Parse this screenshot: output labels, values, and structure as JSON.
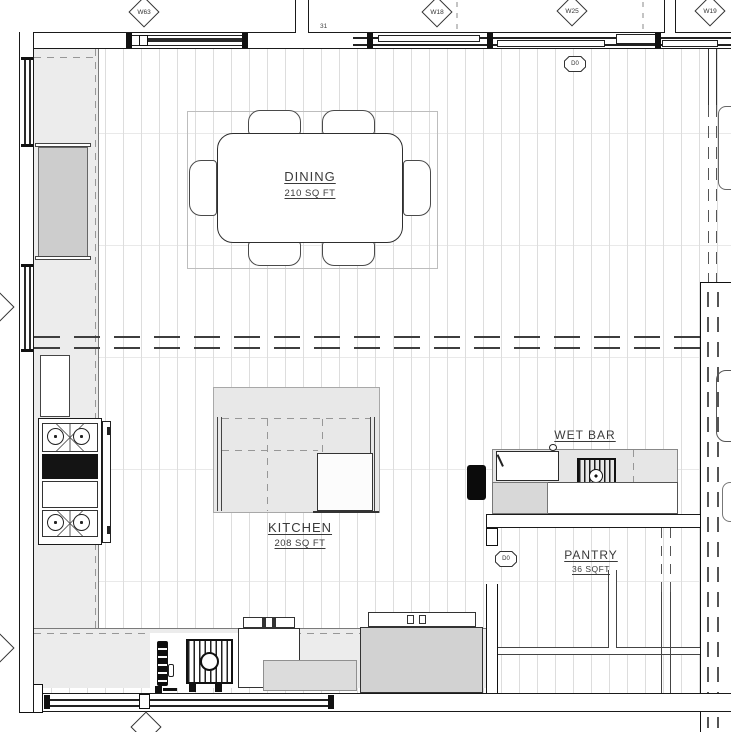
{
  "rooms": {
    "dining": {
      "name": "DINING",
      "area": "210 SQ FT"
    },
    "kitchen": {
      "name": "KITCHEN",
      "area": "208 SQ FT"
    },
    "wet_bar": {
      "name": "WET BAR"
    },
    "pantry": {
      "name": "PANTRY",
      "area": "36 SQFT"
    }
  },
  "tags": {
    "w63": "W63",
    "w18": "W18",
    "w25": "W25",
    "w19": "W19"
  },
  "doors": {
    "top": "D0",
    "pantry": "D0"
  },
  "dims": {
    "top": "31"
  },
  "colors": {
    "line": "#1a1a1a",
    "counter_fill": "#ececec",
    "island_fill": "#e8e8e8",
    "appliance_fill": "#d2d2d2",
    "floor_line": "#dddddd",
    "black_fixture": "#111111"
  }
}
